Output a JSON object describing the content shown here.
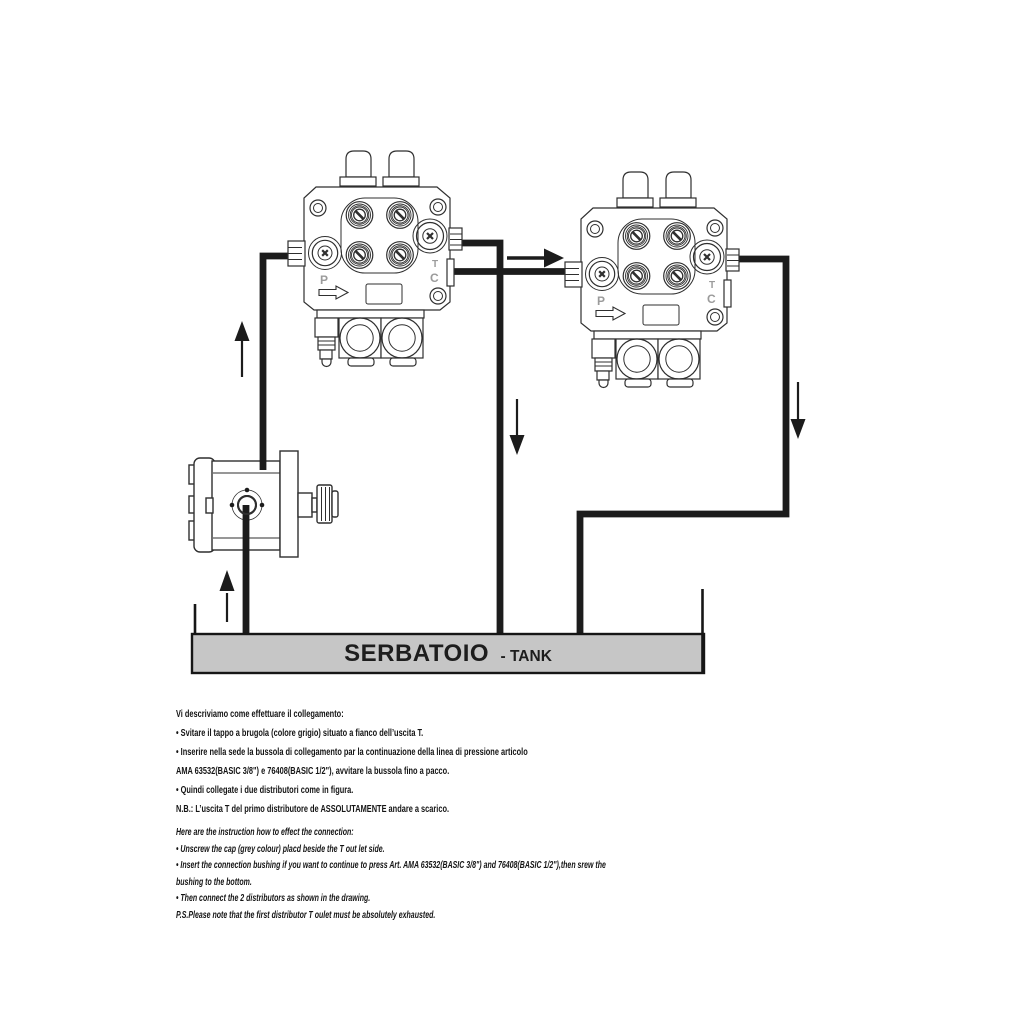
{
  "diagram": {
    "tank": {
      "label_primary": "SERBATOIO",
      "label_secondary": "- TANK",
      "fill_color": "#c6c6c6"
    },
    "valve1": {
      "p": "P",
      "t": "T",
      "c": "C"
    },
    "valve2": {
      "p": "P",
      "t": "T",
      "c": "C"
    }
  },
  "instructions_it": {
    "lines": [
      "Vi descriviamo come effettuare il collegamento:",
      "• Svitare il tappo a brugola (colore grigio) situato a fianco dell’uscita T.",
      "• Inserire nella sede la bussola di collegamento par la continuazione della linea di pressione articolo",
      "AMA 63532(BASIC 3/8\") e 76408(BASIC 1/2\"), avvitare la bussola fino a pacco.",
      "• Quindi collegate i due distributori come in figura.",
      "N.B.: L’uscita T del primo distributore de ASSOLUTAMENTE andare a scarico."
    ]
  },
  "instructions_en": {
    "lines": [
      "Here are the instruction how to effect the connection:",
      "• Unscrew the cap (grey colour) placd beside the T out let side.",
      "• Insert the connection bushing if you want to continue to press Art. AMA 63532(BASIC 3/8\") and 76408(BASIC 1/2\"),then srew the",
      "bushing to the bottom.",
      "• Then connect the 2 distributors as shown in the drawing.",
      "P.S.Please note that the first distributor T oulet must be absolutely exhausted."
    ]
  }
}
